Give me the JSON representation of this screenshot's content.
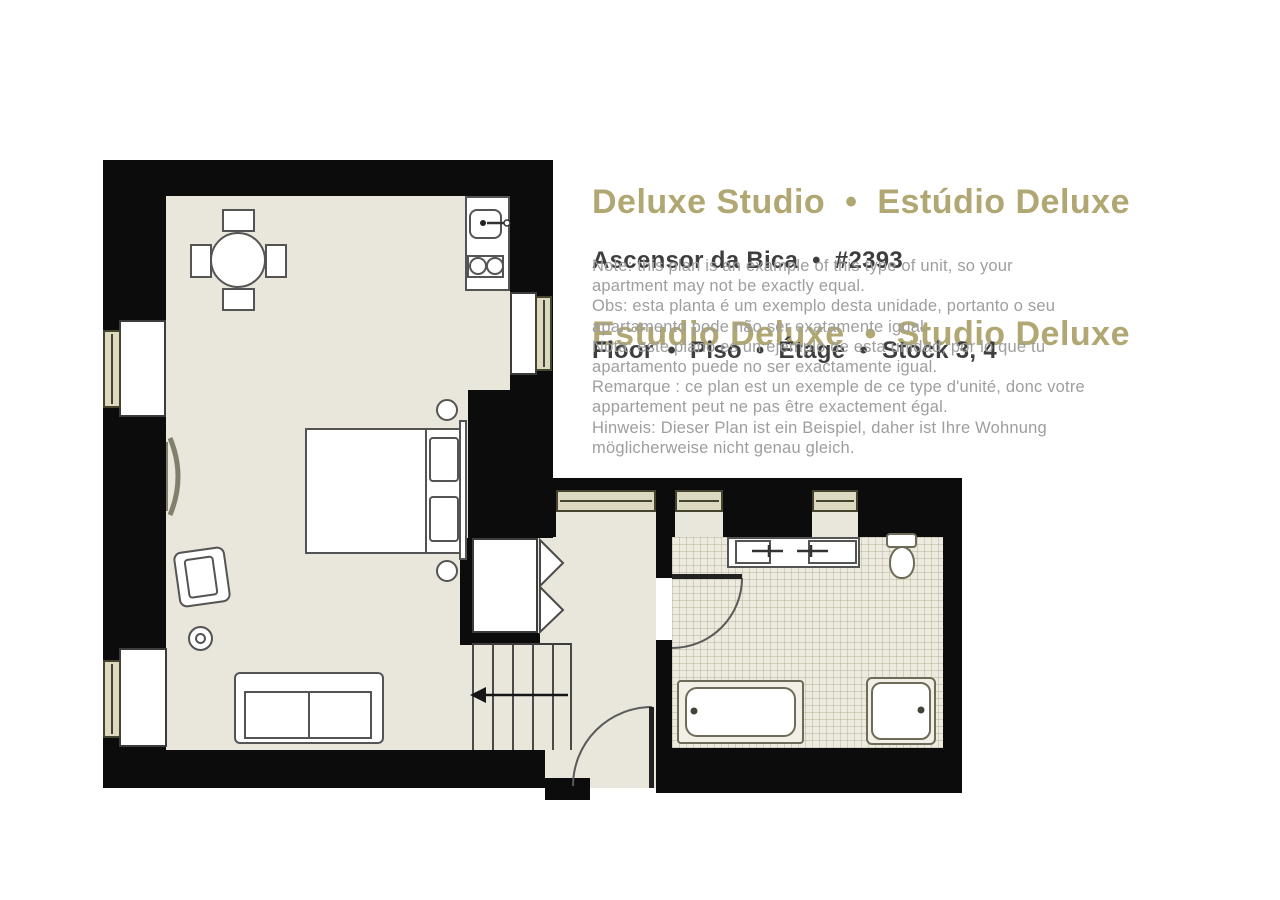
{
  "header": {
    "title_line1": "Deluxe Studio  •  Estúdio Deluxe",
    "title_line2": "Estudio Deluxe  •  Studio Deluxe",
    "property_line": "Ascensor da Bica  •  #2393",
    "floor_line": "Floor  •  Piso  •  Étage  •  Stock 3, 4"
  },
  "notes": {
    "lines": [
      "Note: this plan is an example of this type of unit, so your",
      "apartment may not be exactly equal.",
      "Obs: esta planta é um exemplo desta unidade, portanto o seu",
      "apartamento pode não ser exatamente igual.",
      "Nota: este plano es un ejemplo de esta unidad, por lo que tu",
      "apartamento puede no ser exactamente igual.",
      "Remarque : ce plan est un exemple de ce type d'unité, donc votre",
      "appartement peut ne pas être exactement égal.",
      "Hinweis: Dieser Plan ist ein Beispiel, daher ist Ihre Wohnung",
      "möglicherweise nicht genau gleich."
    ]
  },
  "colors": {
    "title_gold": "#b0a773",
    "heading_dark": "#3e3e3e",
    "note_gray": "#9e9e9e",
    "wall_black": "#0c0c0c",
    "floor_beige": "#e9e6dc",
    "bath_tile": "#edeadf",
    "furniture_outline": "#545454",
    "fixture_outline": "#6e6c58"
  }
}
